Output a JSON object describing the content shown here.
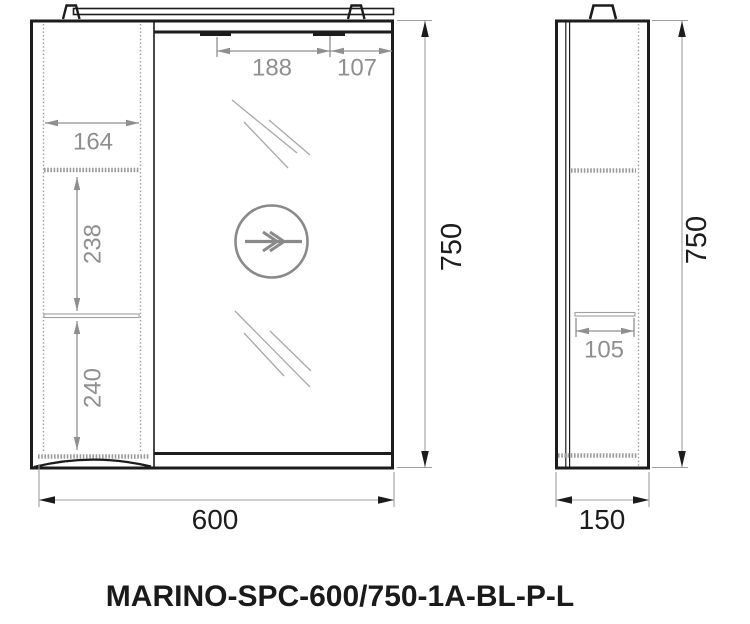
{
  "title": "MARINO-SPC-600/750-1A-BL-P-L",
  "front_view": {
    "dimensions": {
      "lamp_spacing": "188",
      "lamp_to_edge": "107",
      "shelf_width": "164",
      "shelf_gap_upper": "238",
      "shelf_gap_lower": "240",
      "overall_height": "750",
      "overall_width": "600"
    }
  },
  "side_view": {
    "dimensions": {
      "shelf_depth": "105",
      "overall_height": "750",
      "overall_depth": "150"
    }
  },
  "colors": {
    "outline": "#1c1c1c",
    "dimension_gray": "#8f8f8f",
    "hatch_gray": "#9b9b9b",
    "background": "#ffffff"
  }
}
